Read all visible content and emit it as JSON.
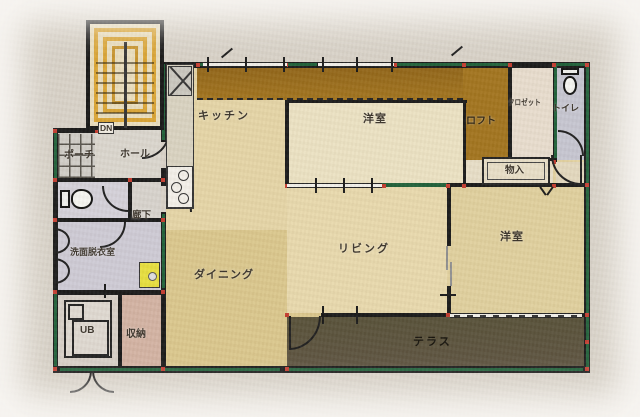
{
  "plan": {
    "rooms": {
      "kitchen": {
        "label": "キッチン"
      },
      "bedroom_top": {
        "label": "洋室"
      },
      "loft": {
        "label": "ロフト"
      },
      "closet": {
        "label": "クロゼット"
      },
      "toilet_upper": {
        "label": "トイレ"
      },
      "storage_small": {
        "label": "物入"
      },
      "porch": {
        "label": "ポーチ"
      },
      "hall": {
        "label": "ホール"
      },
      "stairs": {
        "label": "DN"
      },
      "corridor": {
        "label": "廊下"
      },
      "washroom": {
        "label": "洗面脱衣室"
      },
      "dining": {
        "label": "ダイニング"
      },
      "living": {
        "label": "リビング"
      },
      "bedroom_right": {
        "label": "洋室"
      },
      "unit_bath": {
        "label": "UB"
      },
      "storage": {
        "label": "収納"
      },
      "terrace": {
        "label": "テラス"
      }
    },
    "colors": {
      "wall": "#181818",
      "wall_green": "#1e5f38",
      "joint_red": "#c23b2e",
      "loft_brown": "#a1731d",
      "floor_tan": "#e2d1a0",
      "bedroom_cream": "#eae1c2",
      "terrace_dark": "#5d5340",
      "stair_orange": "#d9a434",
      "wet_room_gray": "#cdcad4",
      "storage_pink": "#d2b2a2",
      "washer_yellow": "#e6de3e"
    }
  }
}
